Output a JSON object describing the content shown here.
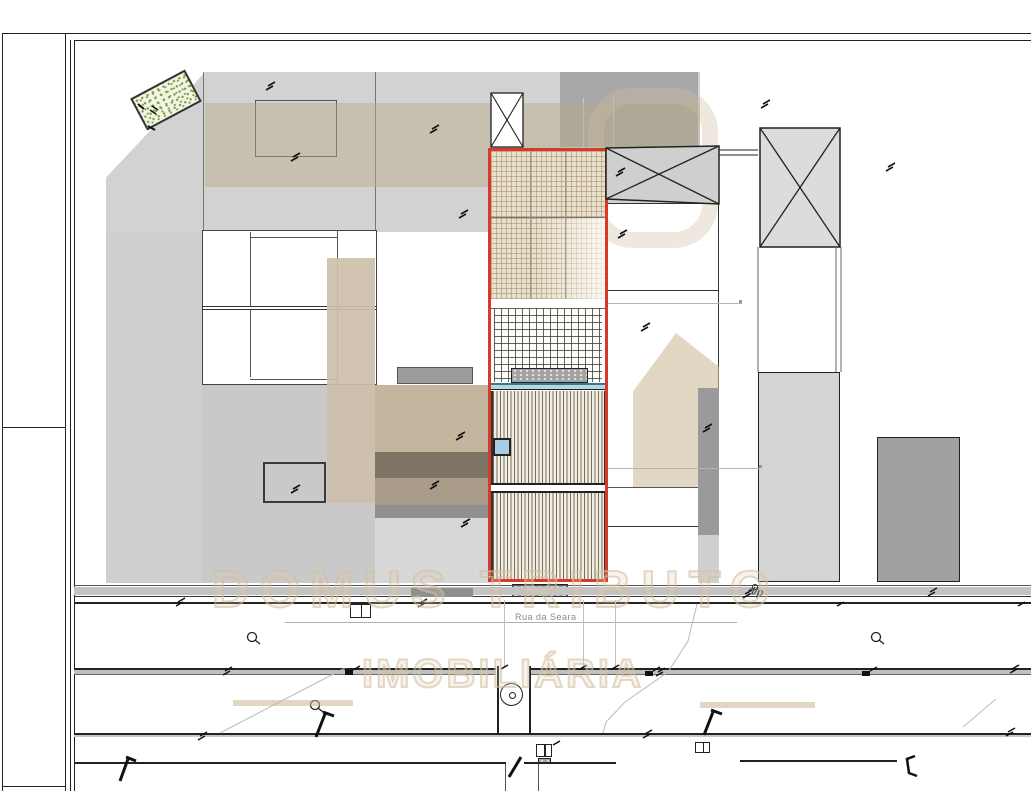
{
  "title": "Site plan drawing",
  "labels": {
    "street": "Rua da Seara",
    "annotation_dp": "d/p"
  },
  "watermark": {
    "line1": "DOMUS TRIBUTO",
    "line2": "IMOBILIÁRIA"
  },
  "colors": {
    "plot-outline": "#d8392b",
    "teal-dark": "#2e7f91",
    "teal-light": "#b9d7e0",
    "watermark-beige": "#d2bf9d",
    "tan-patch": "#cdc0ab",
    "building-light": "#d2d2d2",
    "building-dark": "#a0a0a0",
    "vegetation-green": "#7a9a3d",
    "skylight-blue": "#a9cce2",
    "street-label-gray": "#8a8a8a"
  }
}
